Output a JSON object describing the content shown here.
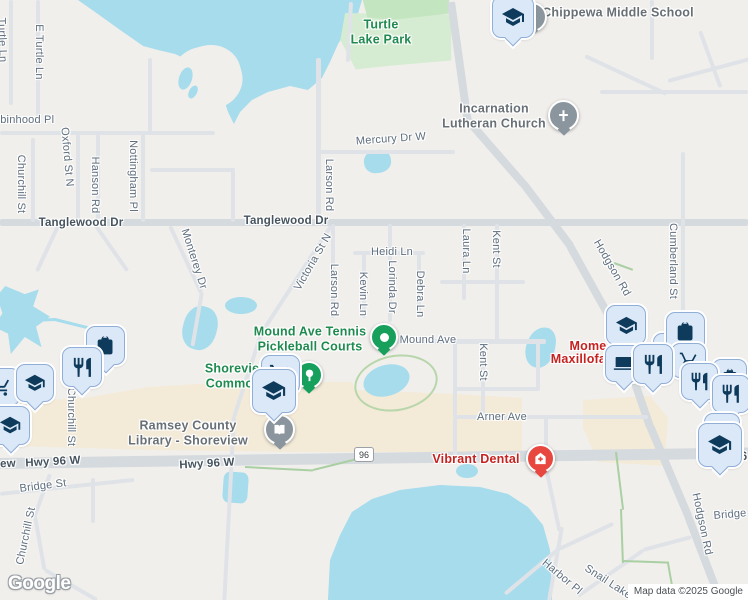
{
  "attribution": "Map data ©2025 Google",
  "logo_text": "Google",
  "route_badge": "96",
  "fragments": {
    "hwy_label_left": "ew",
    "route_right": "6"
  },
  "streets": {
    "e_turtle_ln": "E Turtle Ln",
    "turtle_ln_partial": "Turtle Ln",
    "robinhood_pl": "Robinhood Pl",
    "churchill_st": "Churchill St",
    "oxford_st_n": "Oxford St N",
    "hanson_rd": "Hanson Rd",
    "nottingham_pl": "Nottingham Pl",
    "monterey_dr": "Monterey Dr",
    "tanglewood_dr": "Tanglewood Dr",
    "mercury_dr_w": "Mercury Dr W",
    "larson_rd": "Larson Rd",
    "victoria_st_n": "Victoria St N",
    "heidi_ln": "Heidi Ln",
    "kevin_ln": "Kevin Ln",
    "lorinda_dr": "Lorinda Dr",
    "debra_ln": "Debra Ln",
    "laura_ln": "Laura Ln",
    "kent_st": "Kent St",
    "mound_ave": "Mound Ave",
    "arner_ave": "Arner Ave",
    "hodgson_rd": "Hodgson Rd",
    "cumberland_st": "Cumberland St",
    "hwy_96_w": "Hwy 96 W",
    "bridge_st": "Bridge St",
    "harbor_pl": "Harbor Pl",
    "snail_lake": "Snail Lake"
  },
  "pois": {
    "chippewa_middle_school": "Chippewa Middle School",
    "incarnation_line1": "Incarnation",
    "incarnation_line2": "Lutheran Church",
    "turtle_lake_park_line1": "Turtle",
    "turtle_lake_park_line2": "Lake Park",
    "tennis_line1": "Mound Ave Tennis",
    "tennis_line2": "Pickleball Courts",
    "commons_line1": "Shoreview",
    "commons_line2": "Commons",
    "library_line1": "Ramsey County",
    "library_line2": "Library - Shoreview",
    "vibrant_dental": "Vibrant Dental",
    "momo_frag_a": "Mome",
    "momo_frag_b": "ara",
    "momo_frag_c": "Maxillofac"
  },
  "markers": [
    {
      "id": "chippewa-school",
      "icon": "graduation-cap"
    },
    {
      "id": "incarnation-church",
      "icon": "cross"
    },
    {
      "id": "tennis-courts",
      "icon": "white-dot"
    },
    {
      "id": "commons-park",
      "icon": "tree"
    },
    {
      "id": "commons-saved-cart",
      "icon": "shopping-cart"
    },
    {
      "id": "commons-saved-school",
      "icon": "graduation-cap"
    },
    {
      "id": "library",
      "icon": "open-book"
    },
    {
      "id": "vibrant-dental",
      "icon": "medical-house"
    },
    {
      "id": "left-cluster",
      "icons": [
        "shopping-cart",
        "graduation-cap",
        "fork-knife",
        "shopping-bag",
        "graduation-cap"
      ]
    },
    {
      "id": "right-cluster",
      "icons": [
        "graduation-cap",
        "shopping-bag",
        "shopping-bag",
        "shopping-cart",
        "laptop",
        "fork-knife",
        "shopping-bag",
        "fork-knife",
        "fork-knife"
      ]
    },
    {
      "id": "bottom-right",
      "icon": "graduation-cap"
    }
  ],
  "colors": {
    "water": "#a6dcec",
    "park": "#d6ecd2",
    "commercial": "#f3ead8",
    "marker_fill": "#dbe8f8",
    "marker_icon": "#0e3b5c",
    "poi_green": "#16a05c",
    "poi_gray": "#8a959d",
    "pin_red": "#e8473f",
    "label_green": "#1f8a4e",
    "label_red": "#c5221f"
  }
}
